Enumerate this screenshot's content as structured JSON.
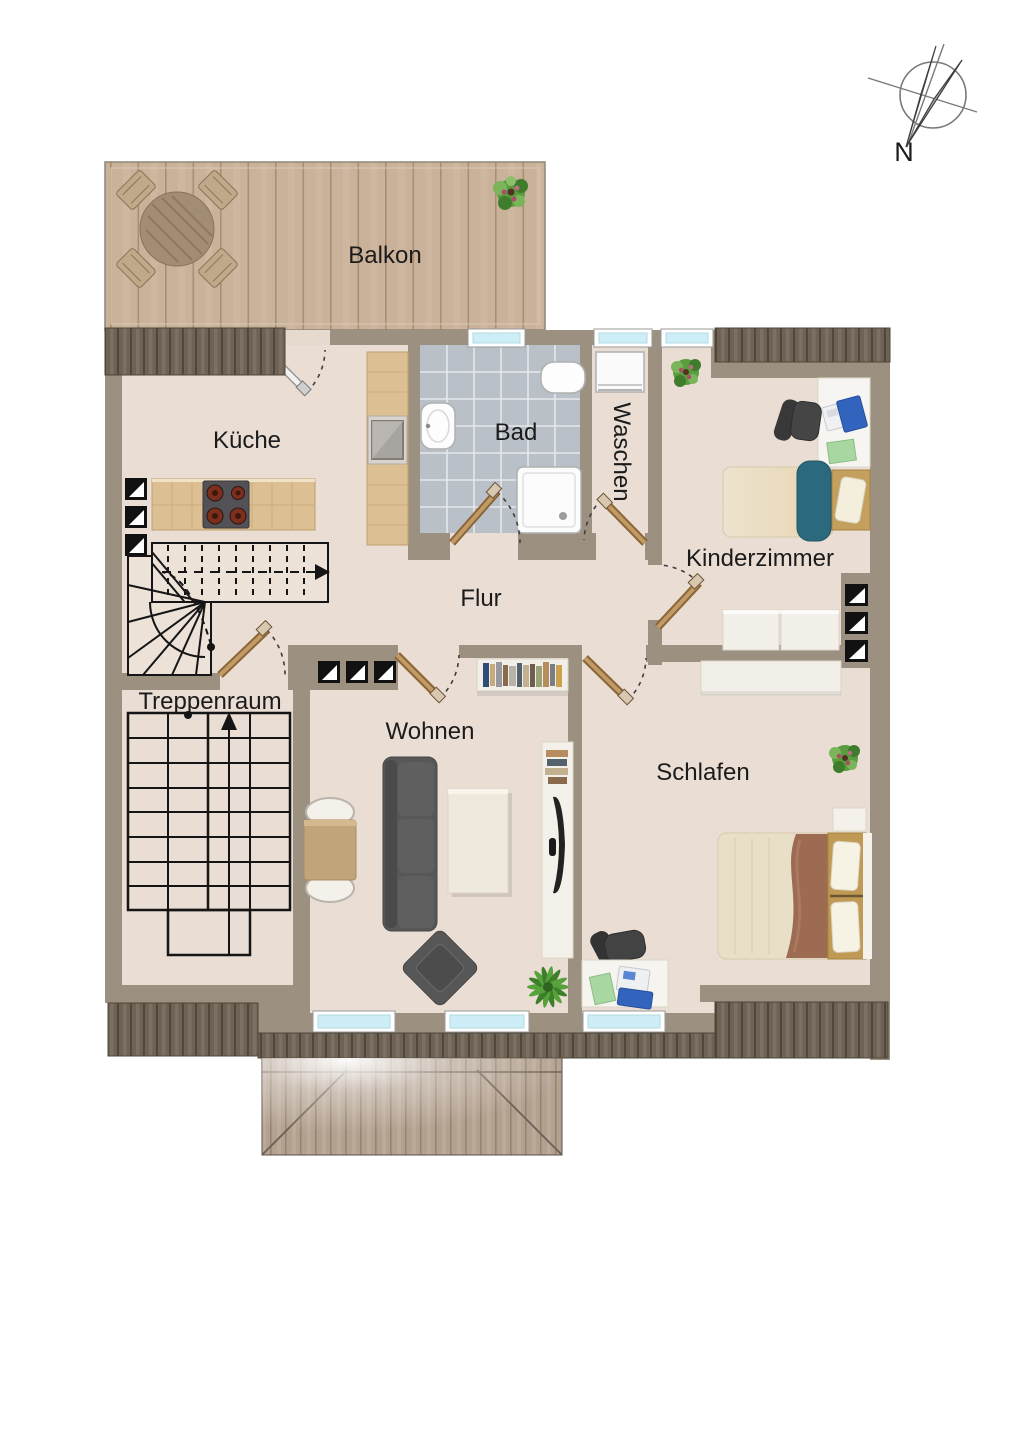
{
  "title": "Dachgeschoss Wohnungsgrundriss",
  "compass": {
    "label": "N"
  },
  "rooms": {
    "balkon": {
      "label": "Balkon"
    },
    "kueche": {
      "label": "Küche"
    },
    "bad": {
      "label": "Bad"
    },
    "waschen": {
      "label": "Waschen"
    },
    "kinderzimmer": {
      "label": "Kinderzimmer"
    },
    "flur": {
      "label": "Flur"
    },
    "treppenraum": {
      "label": "Treppenraum"
    },
    "wohnen": {
      "label": "Wohnen"
    },
    "schlafen": {
      "label": "Schlafen"
    }
  },
  "colors": {
    "wall": "#9c9180",
    "floor": "#e9ddd4",
    "balcony_deck": "#c9b299",
    "roof_wood": "#6e6254",
    "dormer_wood": "#b3a190",
    "bath_tile": "#b9c0c8",
    "counter_wood": "#dcc093",
    "window_glass": "#cdeef7",
    "door_wood": "#ad7f4f",
    "sofa_gray": "#575757",
    "kid_blanket_teal": "#2b6a7e",
    "parent_blanket_brown": "#9c6b52",
    "bed_frame_wood": "#c09a55",
    "laptop_blue": "#3263bd",
    "paper_green": "#a8d7a2",
    "plant_green": "#58a33c",
    "stair_line": "#151515"
  }
}
